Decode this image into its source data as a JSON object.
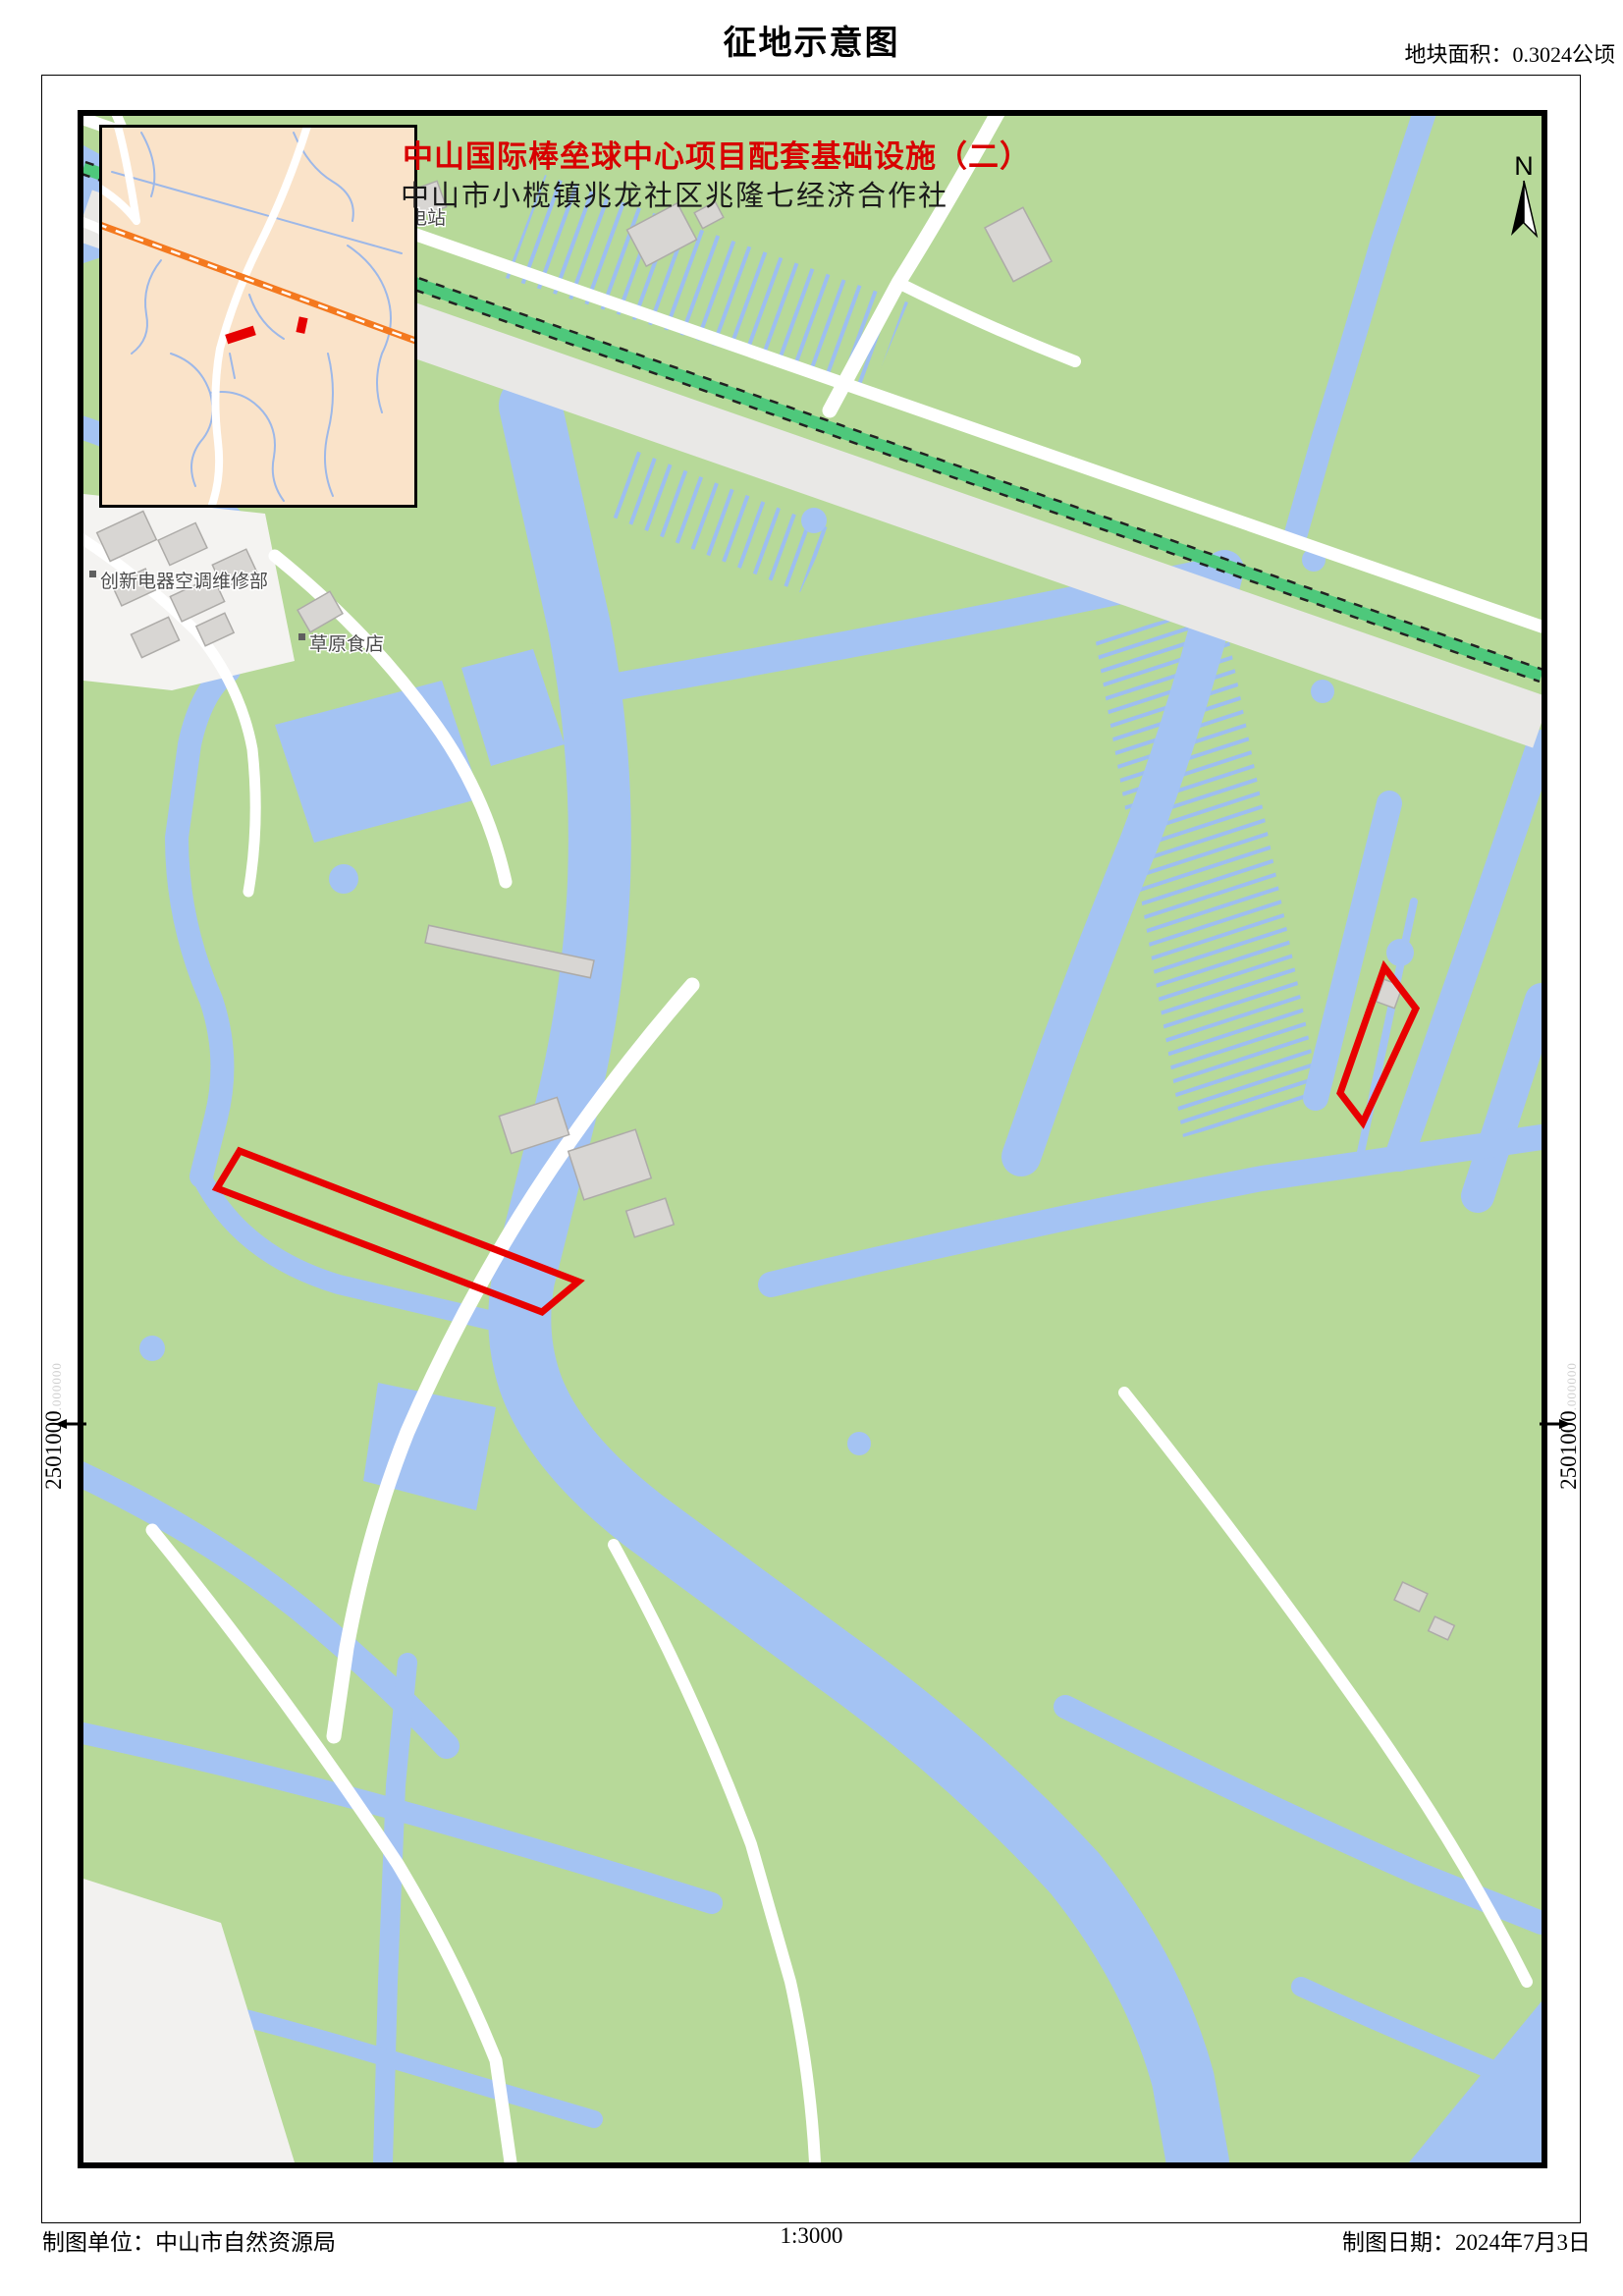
{
  "page": {
    "title": "征地示意图",
    "area_label": "地块面积：0.3024公顷",
    "scale": "1:3000",
    "producer": "制图单位：中山市自然资源局",
    "date": "制图日期：2024年7月3日"
  },
  "map": {
    "project_title": "中山国际棒垒球中心项目配套基础设施（二）",
    "project_subtitle": "中山市小榄镇兆龙社区兆隆七经济合作社",
    "north_label": "N",
    "labels": {
      "poi1": "创新电器空调维修部",
      "poi2": "草原食店",
      "poi3": "乐电站"
    },
    "coordinates": {
      "left": "2501000",
      "left_decimal": "000000",
      "right": "2501000",
      "right_decimal": "000000"
    },
    "colors": {
      "parcel_outline_red": "#e80000",
      "project_title_red": "#d80000",
      "field_green": "#b7d999",
      "water_blue": "#a4c3f3",
      "railway_green": "#4ec87b",
      "road_gray": "#e9e8e6",
      "building_gray": "#d8d6d3",
      "inset_background": "#fae3c9",
      "inset_railway_orange": "#f4791f"
    }
  }
}
